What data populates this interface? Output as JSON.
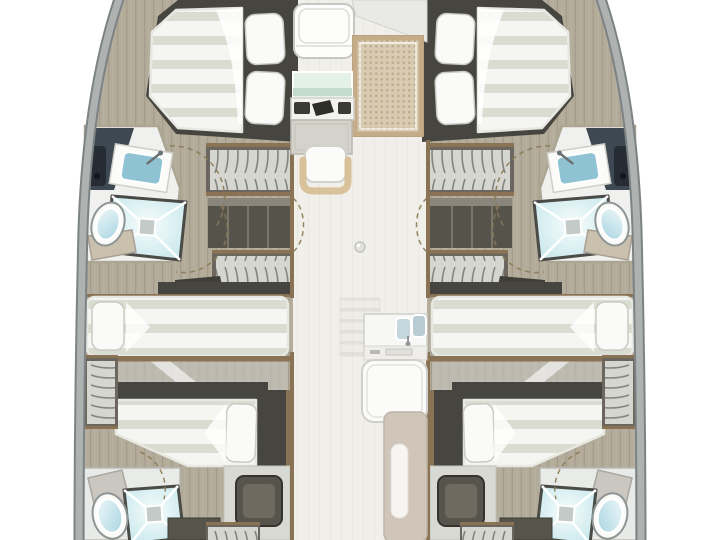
{
  "diagram": {
    "type": "floor-plan",
    "subject": "catamaran-interior-layout-top-view",
    "port_hull": {
      "rooms": [
        "forward double cabin",
        "forward bathroom (washbasin, shower, toilet)",
        "hanging locker",
        "shelf unit",
        "hanging locker",
        "mid double cabin",
        "aft double cabin",
        "aft bathroom (shower, toilet)",
        "aft cabinets and locker"
      ]
    },
    "starboard_hull": {
      "rooms": [
        "forward double cabin",
        "forward bathroom (washbasin, shower, toilet)",
        "hanging locker",
        "shelf unit",
        "hanging locker",
        "mid double cabin",
        "aft double cabin",
        "aft bathroom (shower, toilet)",
        "aft cabinets and locker"
      ]
    },
    "bridgedeck": {
      "features": [
        "salon seat",
        "galley counter",
        "stove with burners",
        "oven cabinet",
        "chair",
        "woven-top table",
        "floor fitting knob",
        "companionway steps",
        "double sink unit",
        "settee",
        "entry panel with step slot"
      ]
    },
    "annotations": [
      "dashed door swing arcs"
    ]
  },
  "palette": {
    "bg": "#ffffff",
    "hull-band": "#aeb3b1",
    "hull-edge": "#7d8385",
    "floor-tan": "#b3ac9a",
    "floor-tan-line": "#a19a88",
    "floor-light": "#f1efe9",
    "wood-trim": "#8a7354",
    "dark-frame": "#46453f",
    "dark-cabinet": "#57544c",
    "cabinet-inner": "#6e6a60",
    "mattress": "#f5f5f1",
    "mattress-stripe": "#d9dcd0",
    "pillow": "#fafaf8",
    "linen-edge": "#c9cbc2",
    "navy-wall": "#3d4852",
    "fixture-dark": "#262c33",
    "basin-blue": "#8fc3d4",
    "aqua-edge": "#c2e6ea",
    "beige": "#d9c19c",
    "woven": "#d9cbb2",
    "woven-dot": "#b5a484",
    "woven-border": "#c3ac87",
    "counter-green": "#bcd9c6",
    "panel-beige": "#cfc5b8",
    "slot-white": "#f6f5f2",
    "white-furniture": "#fbfbf9",
    "gray-outline": "#cfcfca"
  }
}
